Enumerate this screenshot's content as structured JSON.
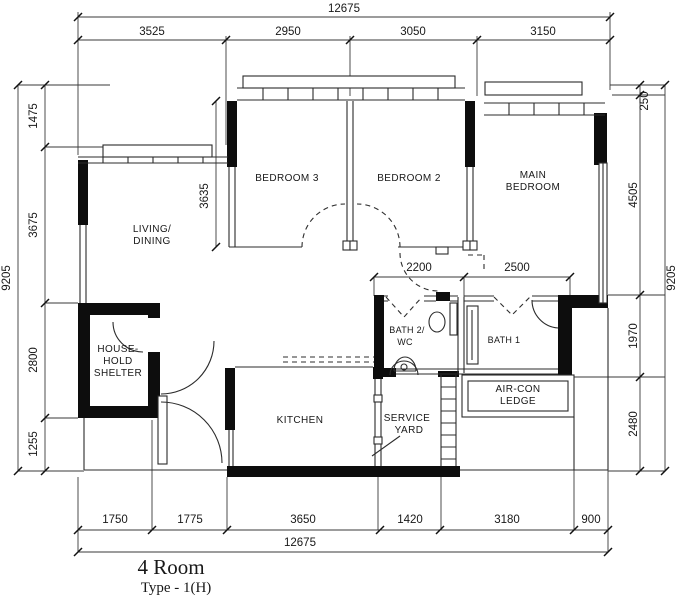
{
  "title": {
    "name": "4 Room",
    "type": "Type - 1(H)"
  },
  "rooms": {
    "living_dining": [
      "LIVING/",
      "DINING"
    ],
    "bedroom3": "BEDROOM 3",
    "bedroom2": "BEDROOM 2",
    "main_bedroom": [
      "MAIN",
      "BEDROOM"
    ],
    "household_shelter": [
      "HOUSE-",
      "HOLD",
      "SHELTER"
    ],
    "kitchen": "KITCHEN",
    "service_yard": [
      "SERVICE",
      "YARD"
    ],
    "aircon_ledge": [
      "AIR-CON",
      "LEDGE"
    ],
    "bath2": [
      "BATH 2/",
      "WC"
    ],
    "bath1": "BATH 1"
  },
  "dims": {
    "top_total": "12675",
    "bottom_total": "12675",
    "left_total": "9205",
    "right_total": "9205",
    "top": [
      "3525",
      "2950",
      "3050",
      "3150"
    ],
    "left": [
      "1475",
      "3675",
      "2800",
      "1255"
    ],
    "right": [
      "250",
      "4505",
      "1970",
      "2480"
    ],
    "bottom": [
      "1750",
      "1775",
      "3650",
      "1420",
      "3180",
      "900"
    ],
    "interior": {
      "bedroom3_depth": "3635",
      "hall_a": "2200",
      "hall_b": "2500"
    }
  },
  "colors": {
    "ink": "#1b1b1b",
    "paper": "#ffffff"
  }
}
